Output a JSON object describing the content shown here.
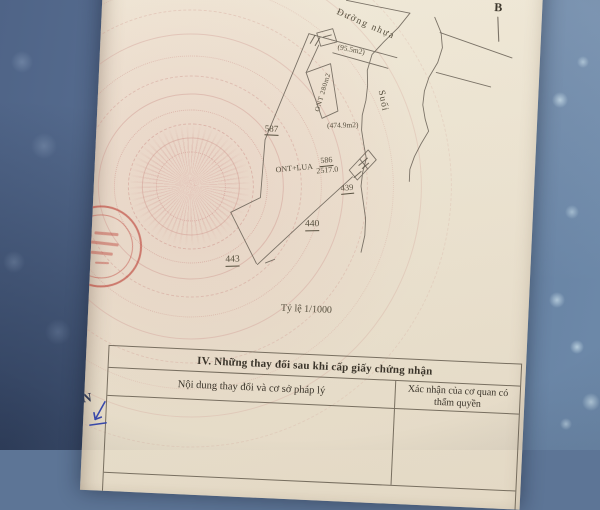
{
  "document": {
    "north_label": "B",
    "map": {
      "road_label": "Đường nhựa",
      "stream_label": "Suối",
      "scale_label": "Tỷ lệ 1/1000",
      "parcels": {
        "p587": "587",
        "p586_type": "ONT+LUA",
        "p586_number": "586",
        "p586_area": "2517.0",
        "p439": "439",
        "p440": "440",
        "p443": "443",
        "strip_label": "ONT 280m2",
        "area_sliver": "(95.5m2)",
        "area_mid": "(474.9m2)"
      }
    },
    "section4": {
      "title": "IV. Những thay đổi sau khi cấp giấy chứng nhận",
      "col1_header": "Nội dung thay đổi và cơ sở pháp lý",
      "col2_header": "Xác nhận của cơ quan có thẩm quyền"
    },
    "handwriting": {
      "letter": "N"
    },
    "colors": {
      "stamp_red": "#ba3a30",
      "pen_blue": "#3949ab",
      "paper": "#f0e9da",
      "fabric": "#5d7596"
    }
  }
}
